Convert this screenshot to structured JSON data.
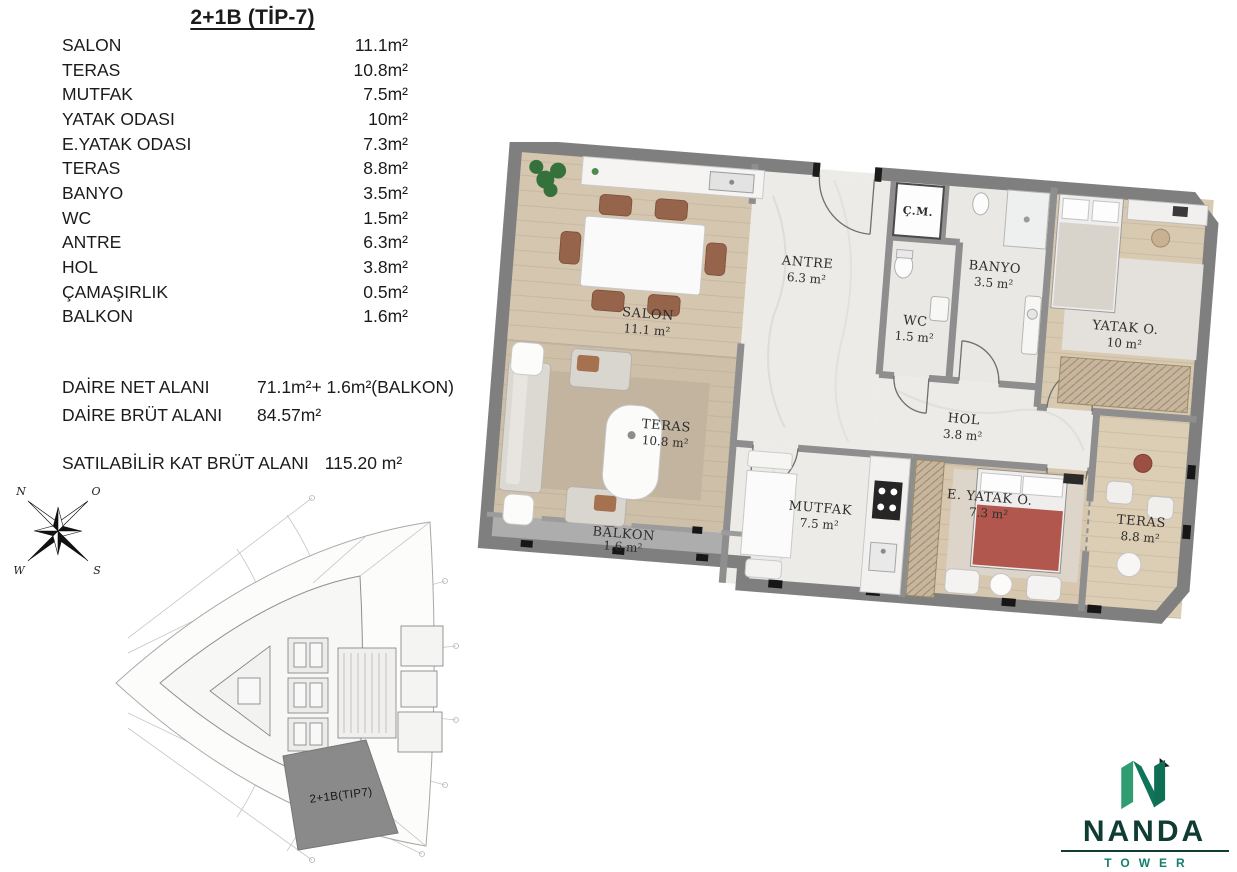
{
  "title": "2+1B (TİP-7)",
  "room_list": {
    "rows": [
      {
        "label": "SALON",
        "area": "11.1m²"
      },
      {
        "label": "TERAS",
        "area": "10.8m²"
      },
      {
        "label": "MUTFAK",
        "area": "7.5m²"
      },
      {
        "label": "YATAK ODASI",
        "area": "10m²"
      },
      {
        "label": "E.YATAK ODASI",
        "area": "7.3m²"
      },
      {
        "label": "TERAS",
        "area": "8.8m²"
      },
      {
        "label": "BANYO",
        "area": "3.5m²"
      },
      {
        "label": "WC",
        "area": "1.5m²"
      },
      {
        "label": "ANTRE",
        "area": "6.3m²"
      },
      {
        "label": "HOL",
        "area": "3.8m²"
      },
      {
        "label": "ÇAMAŞIRLIK",
        "area": "0.5m²"
      },
      {
        "label": "BALKON",
        "area": "1.6m²"
      }
    ]
  },
  "summary": {
    "net_label": "DAİRE NET ALANI",
    "net_value": "71.1m²+ 1.6m²(BALKON)",
    "brut_label": "DAİRE BRÜT ALANI",
    "brut_value": "84.57m²",
    "sellable_label": "SATILABİLİR KAT BRÜT ALANI",
    "sellable_value": "115.20 m²"
  },
  "compass": {
    "n": "N",
    "o": "O",
    "w": "W",
    "s": "S"
  },
  "key_plan": {
    "unit_label": "2+1B(TIP7)"
  },
  "plan": {
    "rooms": [
      {
        "name": "SALON",
        "area": "11.1 m²"
      },
      {
        "name": "TERAS",
        "area": "10.8 m²"
      },
      {
        "name": "BALKON",
        "area": "1.6 m²"
      },
      {
        "name": "ANTRE",
        "area": "6.3 m²"
      },
      {
        "name": "Ç.M."
      },
      {
        "name": "WC",
        "area": "1.5 m²"
      },
      {
        "name": "BANYO",
        "area": "3.5 m²"
      },
      {
        "name": "HOL",
        "area": "3.8 m²"
      },
      {
        "name": "YATAK O.",
        "area": "10 m²"
      },
      {
        "name": "MUTFAK",
        "area": "7.5 m²"
      },
      {
        "name": "E. YATAK O.",
        "area": "7.3 m²"
      },
      {
        "name": "TERAS",
        "area": "8.8 m²"
      }
    ]
  },
  "logo": {
    "name": "NANDA",
    "sub": "TOWER"
  },
  "colors": {
    "brand_green_dark": "#113c34",
    "brand_green": "#2f9c72",
    "brand_teal": "#157f6f",
    "highlight_gray": "#8a8a8a",
    "wall_gray": "#7f7f7f",
    "wood_floor": "#d3c4ad",
    "marble_floor": "#ecebe8"
  }
}
